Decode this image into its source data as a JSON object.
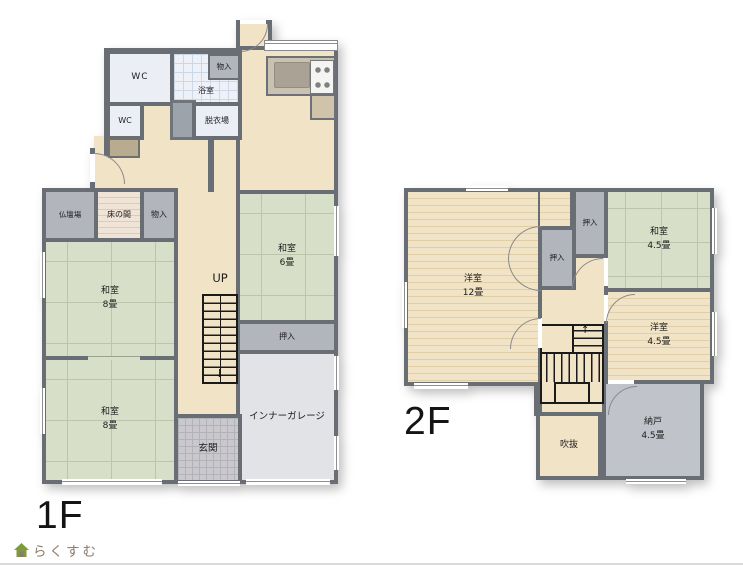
{
  "floor1": {
    "floor_label": "1F",
    "rooms": {
      "wc_top": "WC",
      "bath": "浴室",
      "bath_storage": "物入",
      "wc_bottom": "WC",
      "dressing": "脱衣場",
      "butsudan": "仏壇場",
      "tokonoma": "床の間",
      "hall_storage": "物入",
      "washitsu8_upper": {
        "name": "和室",
        "size": "8畳"
      },
      "washitsu8_lower": {
        "name": "和室",
        "size": "8畳"
      },
      "washitsu6": {
        "name": "和室",
        "size": "6畳"
      },
      "oshiire": "押入",
      "stairs_label": "UP",
      "stairs_down_arrow": "↓",
      "genkan": "玄関",
      "garage": "インナーガレージ"
    }
  },
  "floor2": {
    "floor_label": "2F",
    "rooms": {
      "yoshitsu12": {
        "name": "洋室",
        "size": "12畳"
      },
      "oshiire_a": "押入",
      "oshiire_b": "押入",
      "washitsu45": {
        "name": "和室",
        "size": "4.5畳"
      },
      "yoshitsu45": {
        "name": "洋室",
        "size": "4.5畳"
      },
      "nando": {
        "name": "納戸",
        "size": "4.5畳"
      },
      "void": "吹抜",
      "stairs_up_arrow": "↑"
    }
  },
  "footer": {
    "logo_text": "らくすむ"
  },
  "colors": {
    "wall": "#696d74",
    "tatami": "#d8dfc9",
    "wood_floor": "#f1e3c6",
    "closet_gray": "#b2b6bc",
    "garage_gray": "#e2e3e6",
    "logo_brown": "#8b7b6e",
    "logo_green": "#7d9a3d"
  }
}
